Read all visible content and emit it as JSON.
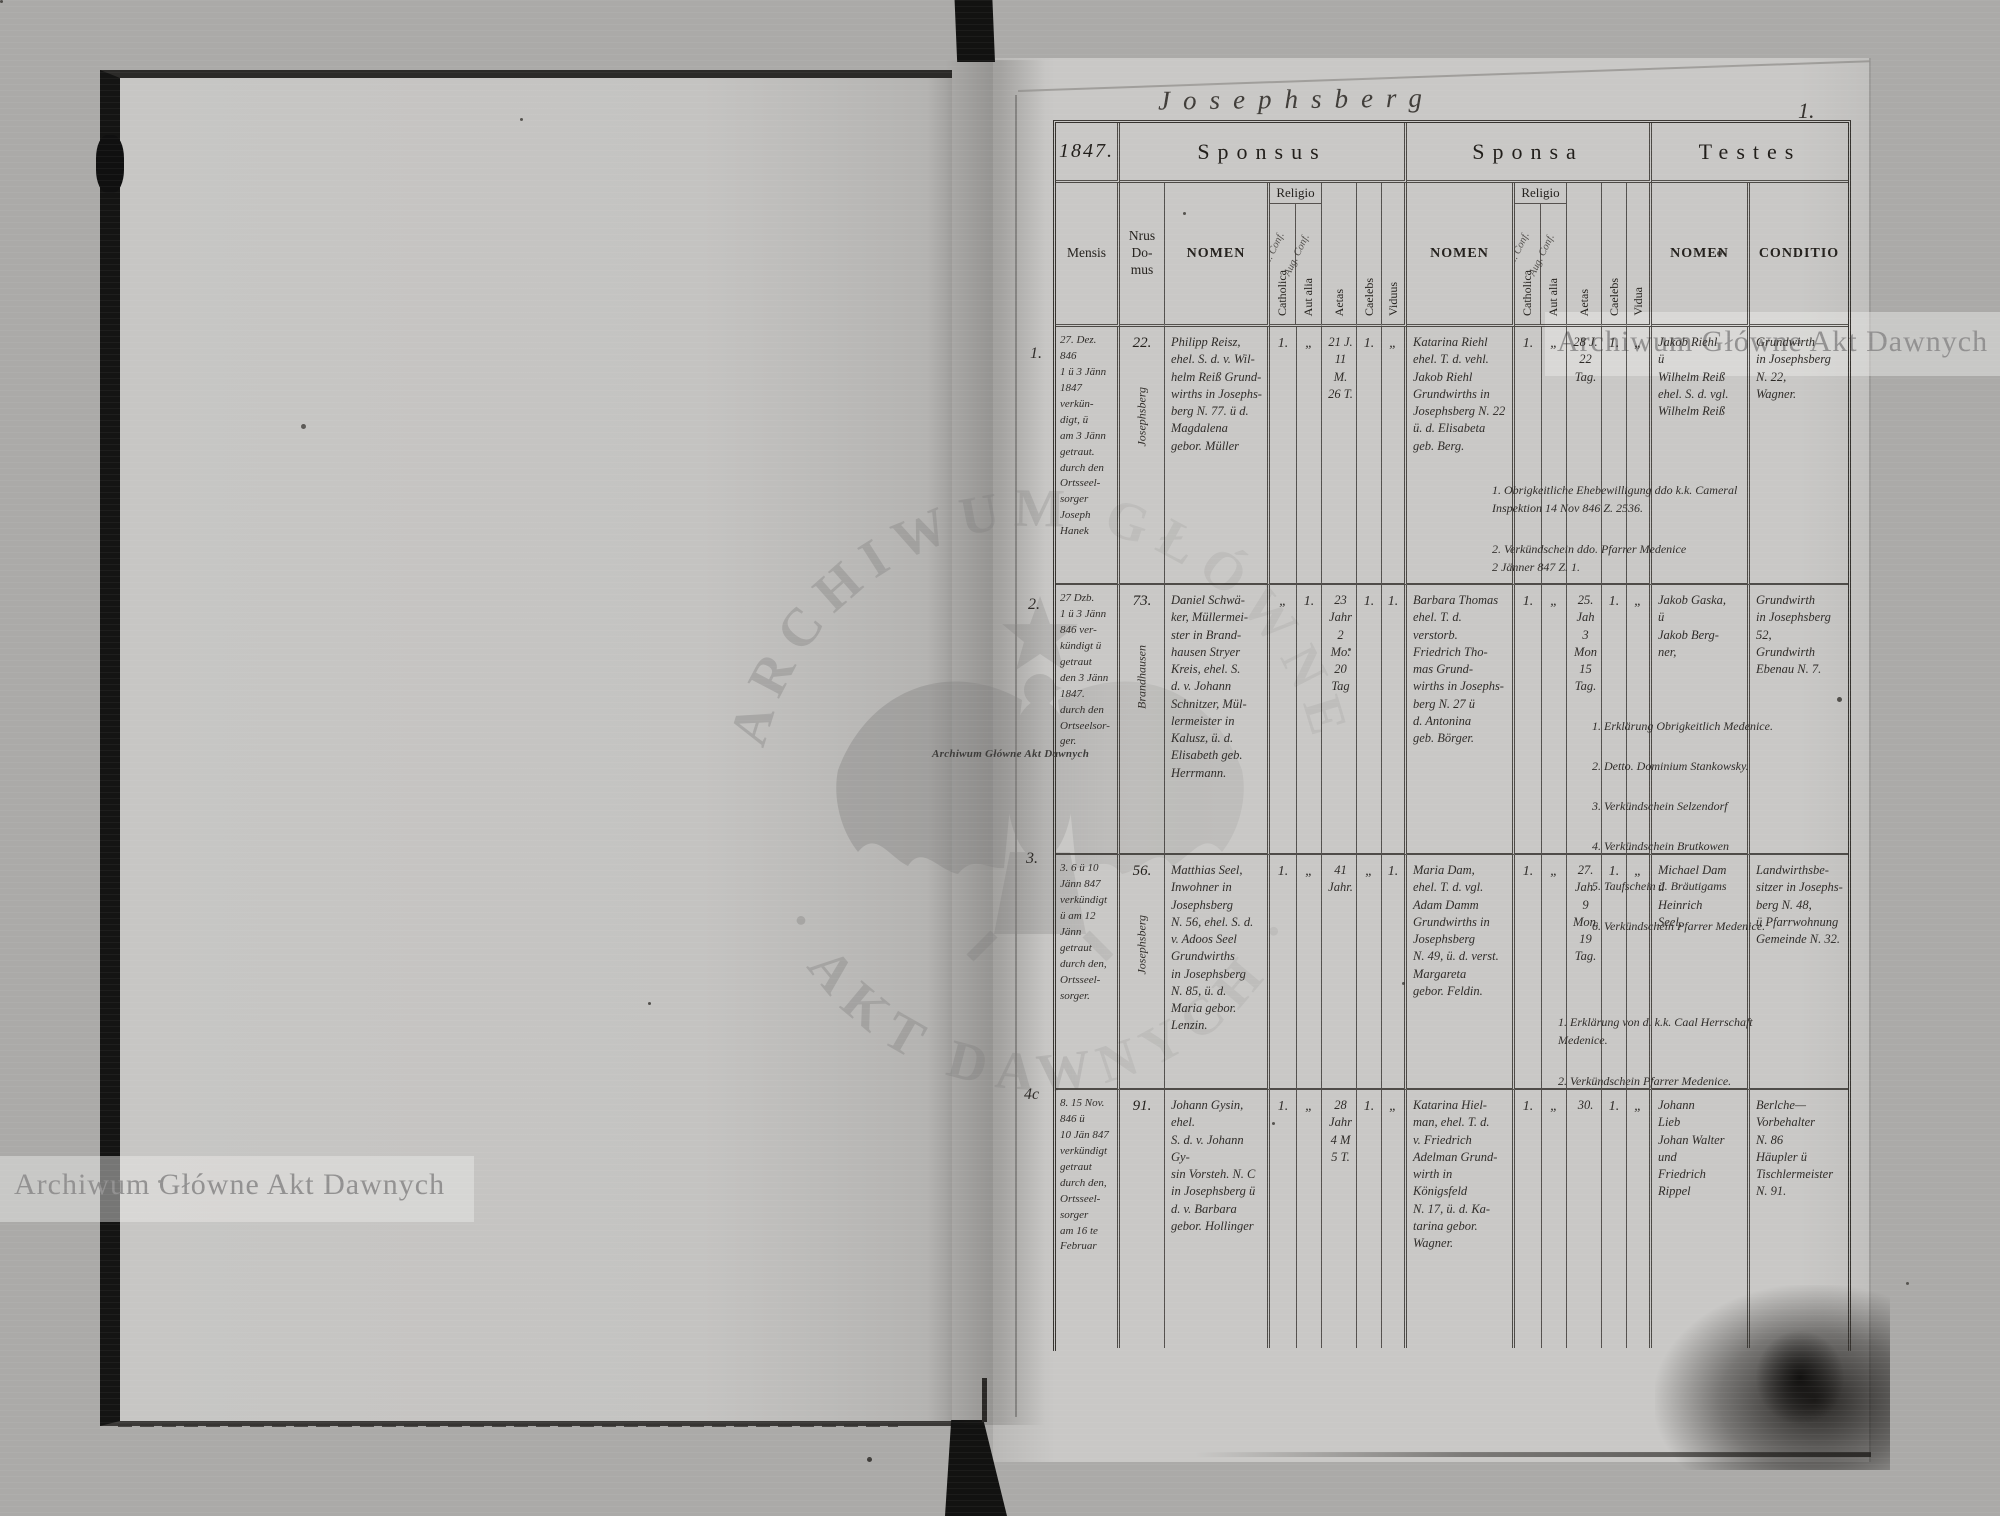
{
  "scan": {
    "archive_watermark": {
      "ring_top": "ARCHIWUM GŁÓWNE",
      "ring_bottom": "· AKT DAWNYCH ·",
      "band": "Archiwum Główne Akt Dawnych"
    },
    "page_title": "Josephsberg",
    "page_number": "1."
  },
  "table": {
    "year": "1847.",
    "groups": {
      "sponsus": "Sponsus",
      "sponsa": "Sponsa",
      "testes": "Testes"
    },
    "headers": {
      "mensis": "Mensis",
      "domus": "Nrus\nDo-\nmus",
      "nomen": "NOMEN",
      "religio": "Religio",
      "catholica": "Catholica",
      "aut_alia": "Aut alia",
      "aetas": "Aetas",
      "caelebs": "Caelebs",
      "viduus": "Viduus",
      "vidua": "Vidua",
      "conditio": "CONDITIO",
      "scrawl_cath": "Helv. Conf.",
      "scrawl_alia": "Aug. Conf."
    }
  },
  "rows": [
    {
      "num": "1.",
      "mensis": "27. Dez. 846\n1 ü 3 Jänn\n1847 verkün-\ndigt, ü\nam 3 Jänn\ngetraut.\ndurch den\nOrtsseel-\nsorger Joseph\nHanek",
      "place": "Josephsberg",
      "domus": "22.",
      "sp_nomen": "Philipp Reisz,\nehel. S. d. v. Wil-\nhelm Reiß Grund-\nwirths in Josephs-\nberg N. 77. ü d.\nMagdalena\ngebor. Müller",
      "sp_cath": "1.",
      "sp_alia": "„",
      "sp_aetas": "21 J.\n11 M.\n26 T.",
      "sp_cael": "1.",
      "sp_vid": "„",
      "sa_nomen": "Katarina Riehl\nehel. T. d. vehl.\nJakob Riehl\nGrundwirths in\nJosephsberg N. 22\nü. d. Elisabeta\ngeb. Berg.",
      "sa_cath": "1.",
      "sa_alia": "„",
      "sa_aetas": "28 J.\n22\nTag.",
      "sa_cael": "1.",
      "sa_vid": "„",
      "t_nomen": "Jakob Riehl\nü\nWilhelm Reiß\nehel. S. d. vgl.\nWilhelm Reiß",
      "conditio": "Grundwirth\nin Josephsberg\nN. 22,\nWagner.",
      "notes": [
        "1. Obrigkeitliche Ehebewilligung ddo k.k. Cameral\nInspektion 14 Nov 846 Z. 2536.",
        "2. Verkündschein ddo. Pfarrer Medenice\n2 Jänner 847 Z. 1."
      ]
    },
    {
      "num": "2.",
      "mensis": "27 Dzb.\n1 ü 3 Jänn\n846 ver-\nkündigt ü\ngetraut\nden 3 Jänn\n1847.\ndurch den\nOrtseelsor-\nger.",
      "place": "Brandhausen",
      "domus": "73.",
      "sp_nomen": "Daniel Schwä-\nker, Müllermei-\nster in Brand-\nhausen Stryer\nKreis, ehel. S.\nd. v. Johann\nSchnitzer, Mül-\nlermeister in\nKalusz, ü. d.\nElisabeth geb.\nHerrmann.",
      "sp_cath": "„",
      "sp_alia": "1.",
      "sp_aetas": "23\nJahr\n2\nMo.\n20\nTag",
      "sp_cael": "1.",
      "sp_vid": "1.",
      "sa_nomen": "Barbara Thomas\nehel. T. d. verstorb.\nFriedrich Tho-\nmas Grund-\nwirths in Josephs-\nberg N. 27 ü\nd. Antonina\ngeb. Börger.",
      "sa_cath": "1.",
      "sa_alia": "„",
      "sa_aetas": "25.\nJah\n3\nMon\n15\nTag.",
      "sa_cael": "1.",
      "sa_vid": "„",
      "t_nomen": "Jakob Gaska,\nü\nJakob Berg-\nner,",
      "conditio": "Grundwirth\nin Josephsberg\n52,\nGrundwirth\nEbenau N. 7.",
      "notes": [
        "1. Erklärung Obrigkeitlich Medenice.",
        "2. Detto. Dominium Stankowsky.",
        "3. Verkündschein Selzendorf",
        "4. Verkündschein Brutkowen",
        "5. Taufschein d. Bräutigams",
        "6. Verkündschein Pfarrer Medenice."
      ]
    },
    {
      "num": "3.",
      "mensis": "3. 6 ü 10\nJänn 847\nverkündigt\nü am 12 Jänn\ngetraut\ndurch den,\nOrtsseel-\nsorger.",
      "place": "Josephsberg",
      "domus": "56.",
      "sp_nomen": "Matthias Seel,\nInwohner in\nJosephsberg\nN. 56, ehel. S. d.\nv. Adoos Seel\nGrundwirths\nin Josephsberg\nN. 85, ü. d.\nMaria gebor.\nLenzin.",
      "sp_cath": "1.",
      "sp_alia": "„",
      "sp_aetas": "41\nJahr.",
      "sp_cael": "„",
      "sp_vid": "1.",
      "sa_nomen": "Maria Dam,\nehel. T. d. vgl.\nAdam Damm\nGrundwirths in\nJosephsberg\nN. 49, ü. d. verst.\nMargareta\ngebor. Feldin.",
      "sa_cath": "1.",
      "sa_alia": "„",
      "sa_aetas": "27.\nJah.\n9\nMon.\n19\nTag.",
      "sa_cael": "1.",
      "sa_vid": "„",
      "t_nomen": "Michael Dam\nü\nHeinrich\nSeel,",
      "conditio": "Landwirthsbe-\nsitzer in Josephs-\nberg N. 48,\nü Pfarrwohnung\nGemeinde N. 32.",
      "notes": [
        "1. Erklärung von d. k.k. Caal Herrschaft\nMedenice.",
        "2. Verkündschein Pfarrer Medenice."
      ]
    },
    {
      "num": "4c",
      "mensis": "8. 15 Nov.\n846 ü\n10 Jän 847\nverkündigt\ngetraut\ndurch den,\nOrtsseel-\nsorger\nam 16 te\nFebruar",
      "place": "",
      "domus": "91.",
      "sp_nomen": "Johann Gysin, ehel.\nS. d. v. Johann Gy-\nsin Vorsteh. N. C\nin Josephsberg ü\nd. v. Barbara\ngebor. Hollinger",
      "sp_cath": "1.",
      "sp_alia": "„",
      "sp_aetas": "28\nJahr\n4 M\n5 T.",
      "sp_cael": "1.",
      "sp_vid": "„",
      "sa_nomen": "Katarina Hiel-\nman, ehel. T. d.\nv. Friedrich\nAdelman Grund-\nwirth in Königsfeld\nN. 17, ü. d. Ka-\ntarina gebor.\nWagner.",
      "sa_cath": "1.",
      "sa_alia": "„",
      "sa_aetas": "30.",
      "sa_cael": "1.",
      "sa_vid": "„",
      "t_nomen": "Johann\nLieb\nJohan Walter\nund\nFriedrich\nRippel",
      "conditio": "Berlche—\nVorbehalter\nN. 86\nHäupler ü\nTischlermeister\nN. 91.",
      "notes": []
    }
  ]
}
